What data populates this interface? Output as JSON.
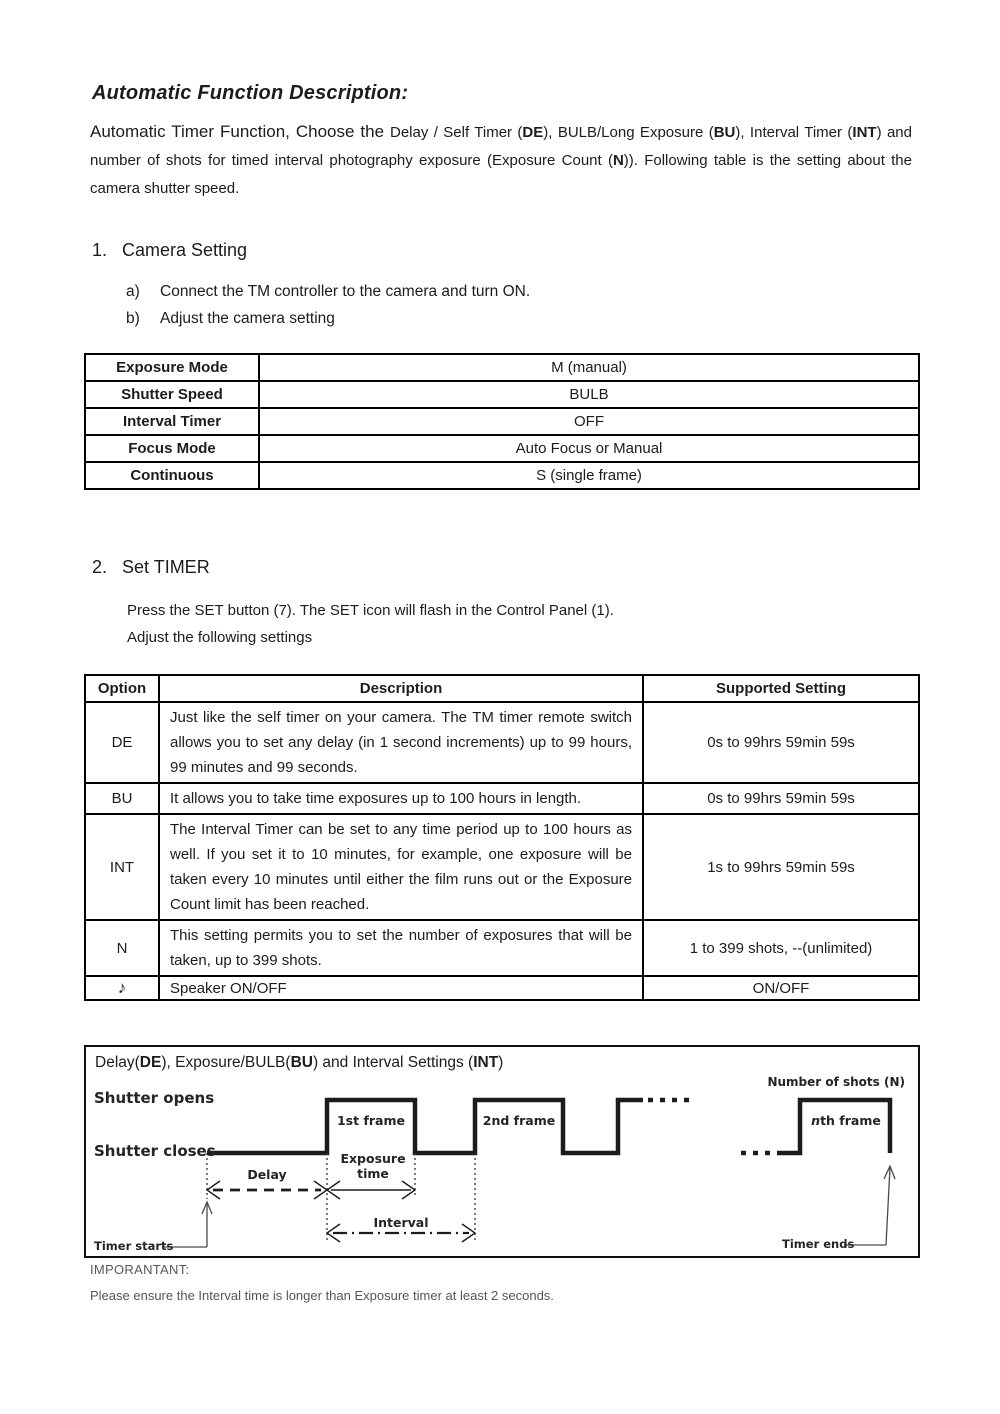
{
  "page": {
    "title": "Automatic Function Description:"
  },
  "intro": {
    "lead": "Automatic Timer Function, Choose the ",
    "s1": "Delay / Self Timer (",
    "b1": "DE",
    "s2": "), BULB/Long Exposure (",
    "b2": "BU",
    "s3": "), Interval Timer (",
    "b3": "INT",
    "s4": ") and number of shots for timed interval photography exposure (Exposure Count (",
    "b4": "N",
    "s5": ")). Following table is the setting about the camera shutter speed."
  },
  "section1": {
    "number": "1.",
    "label": "Camera Setting",
    "items": [
      {
        "marker": "a)",
        "text": "Connect the TM controller to the camera and turn ON."
      },
      {
        "marker": "b)",
        "text": "Adjust the camera setting"
      }
    ]
  },
  "camera_table": {
    "rows": [
      {
        "label": "Exposure Mode",
        "value": "M (manual)"
      },
      {
        "label": "Shutter Speed",
        "value": "BULB"
      },
      {
        "label": "Interval Timer",
        "value": "OFF"
      },
      {
        "label": "Focus Mode",
        "value": "Auto Focus or Manual"
      },
      {
        "label": "Continuous",
        "value": "S (single frame)"
      }
    ]
  },
  "section2": {
    "number": "2.",
    "label": "Set TIMER",
    "line1": "Press the SET button (7). The SET icon will flash in the Control Panel (1).",
    "line2": "Adjust the following settings"
  },
  "timer_table": {
    "headers": [
      "Option",
      "Description",
      "Supported Setting"
    ],
    "rows": [
      {
        "option": "DE",
        "description": "Just like the self timer on your camera.  The TM timer remote switch allows you to set any delay (in 1 second increments) up to 99 hours, 99 minutes and 99 seconds.",
        "setting": "0s to 99hrs 59min 59s"
      },
      {
        "option": "BU",
        "description": "It allows you to take time exposures up to 100 hours in length.",
        "setting": "0s to 99hrs 59min 59s"
      },
      {
        "option": "INT",
        "description": "The Interval Timer can be set to any time period up to 100 hours as well. If you set it to 10 minutes, for example, one exposure will be taken every 10 minutes until either the film runs out or the Exposure Count limit has been reached.",
        "setting": "1s to 99hrs 59min 59s"
      },
      {
        "option": "N",
        "description": "This setting permits you to set the number of exposures that will be taken, up to 399 shots.",
        "setting": "1 to 399 shots, --(unlimited)"
      },
      {
        "option": "♪",
        "description": "Speaker ON/OFF",
        "setting": "ON/OFF"
      }
    ]
  },
  "diagram": {
    "title": {
      "t1": "Delay(",
      "b1": "DE",
      "t2": "), Exposure/BULB(",
      "b2": "BU",
      "t3": ") and Interval Settings (",
      "b3": "INT",
      "t4": ")"
    },
    "labels": {
      "shots_prefix": "Number of shots (",
      "shots_bold": "N",
      "shots_suffix": ")",
      "shutter_opens": "Shutter opens",
      "shutter_closes": "Shutter closes",
      "frame1": "1st frame",
      "frame2": "2nd frame",
      "frame_n_italic": "n",
      "frame_n_rest": "th frame",
      "exposure_line1": "Exposure",
      "exposure_line2": "time",
      "delay": "Delay",
      "interval": "Interval",
      "timer_starts": "Timer starts",
      "timer_ends": "Timer ends"
    }
  },
  "footer": {
    "important": "IMPORANTANT:",
    "note": "Please ensure the Interval time is longer than Exposure timer at least 2 seconds."
  },
  "colors": {
    "ink": "#1c1c1c",
    "muted": "#555555"
  }
}
